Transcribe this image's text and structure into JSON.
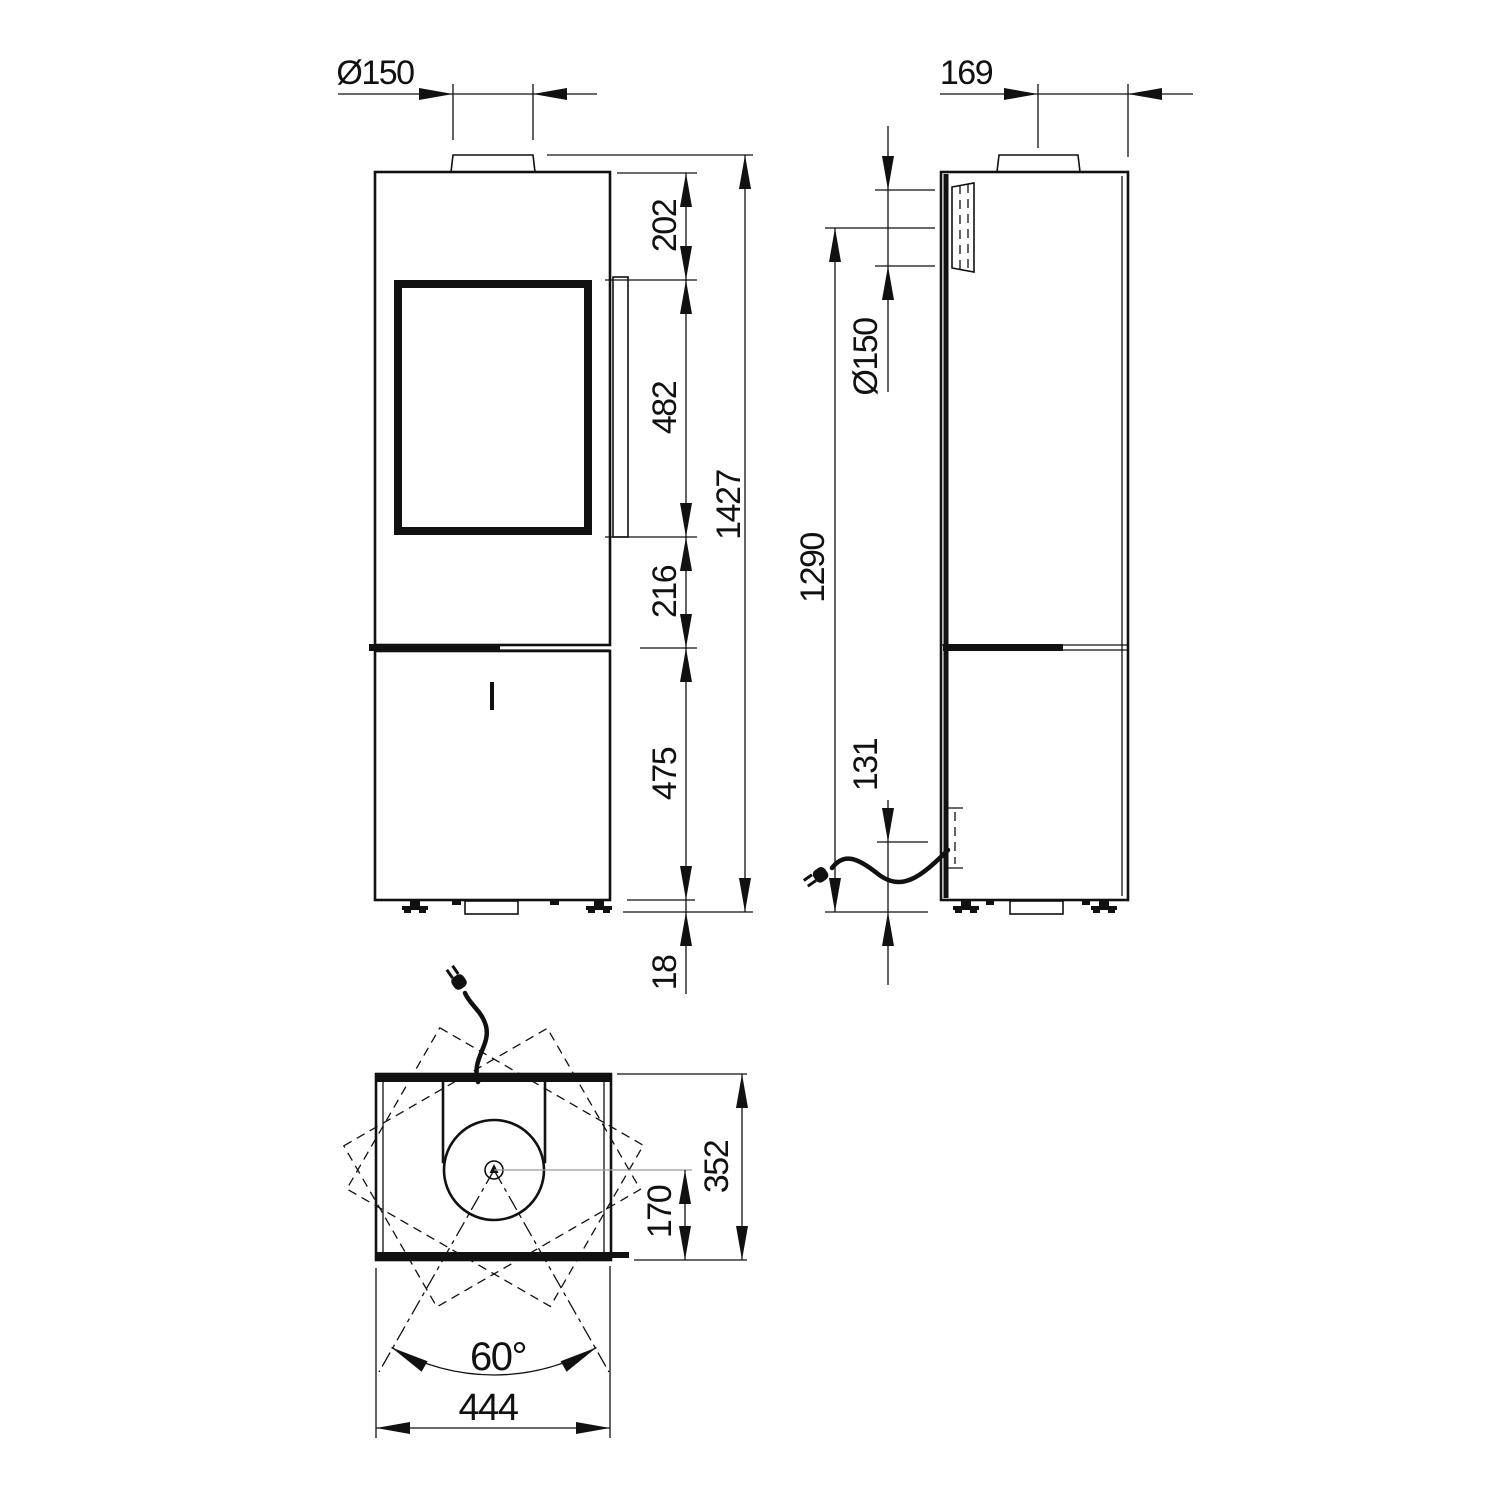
{
  "front_view": {
    "flue_diameter": "Ø150",
    "top_to_door": "202",
    "door_height": "482",
    "door_to_base": "216",
    "base_height": "475",
    "total_height": "1427",
    "feet_height": "18"
  },
  "side_view": {
    "flue_offset_to_back": "169",
    "rear_flue_diameter": "Ø150",
    "floor_to_rear_flue_center": "1290",
    "power_inlet_height": "131"
  },
  "top_view": {
    "depth": "352",
    "flue_center_to_front": "170",
    "swivel_angle": "60°",
    "width": "444"
  },
  "colors": {
    "line": "#111111",
    "centerline": "#9a9a9a",
    "background": "#ffffff"
  }
}
